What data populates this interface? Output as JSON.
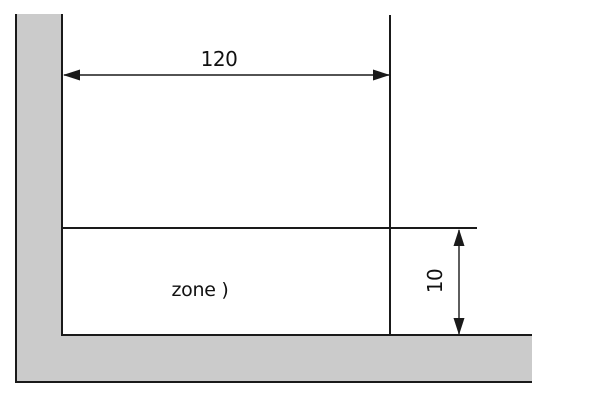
{
  "diagram": {
    "dimensions": [
      {
        "label": "120",
        "orientation": "horizontal"
      },
      {
        "label": "10",
        "orientation": "vertical"
      }
    ],
    "zone": {
      "label": "zone )"
    },
    "colors": {
      "wall_fill": "#cbcbcb",
      "line": "#1a1a1a",
      "text": "#111111",
      "background": "#ffffff"
    }
  }
}
